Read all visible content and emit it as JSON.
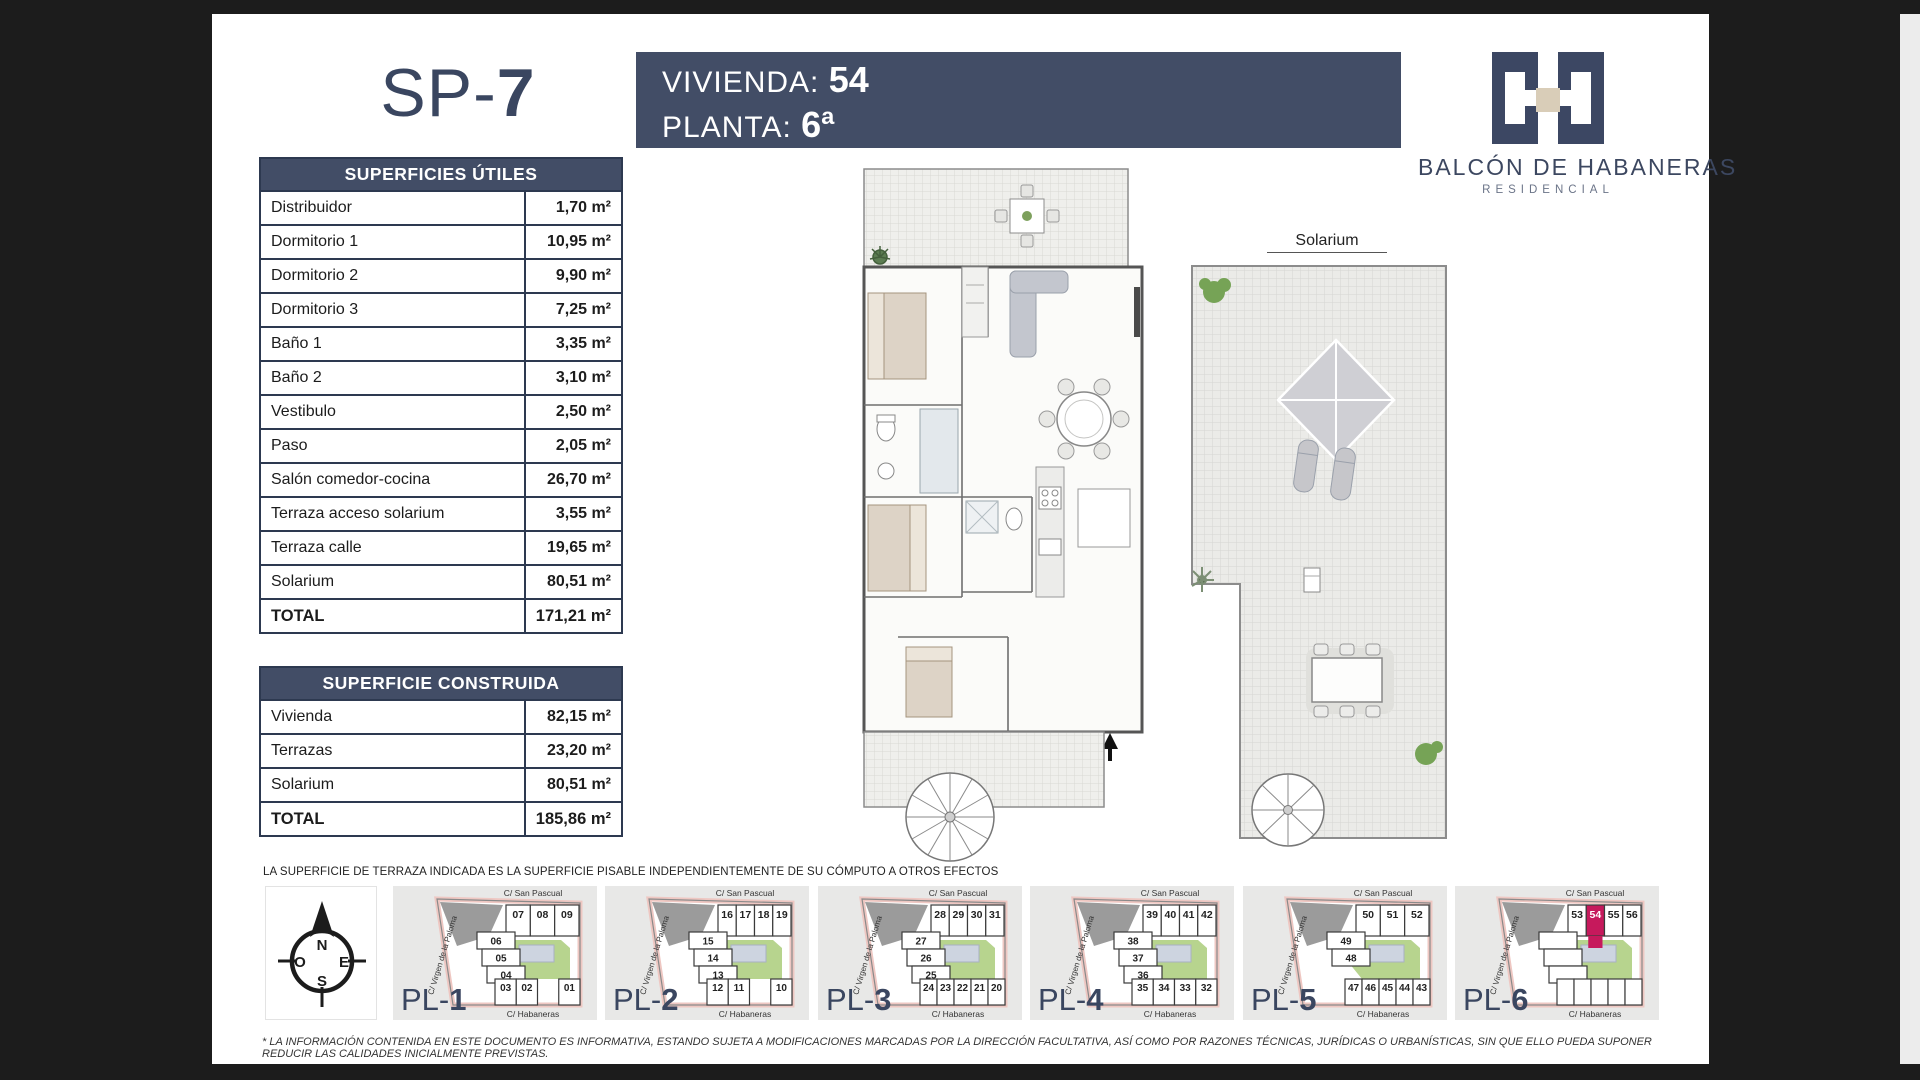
{
  "header": {
    "unit_code_prefix": "SP-",
    "unit_code_num": "7",
    "vivienda_label": "VIVIENDA:",
    "vivienda_value": "54",
    "planta_label": "PLANTA:",
    "planta_value": "6ª"
  },
  "brand": {
    "name": "BALCÓN DE HABANERAS",
    "subtitle": "RESIDENCIAL"
  },
  "solarium_label": "Solarium",
  "tables": {
    "useful": {
      "title": "SUPERFICIES ÚTILES",
      "rows": [
        {
          "label": "Distribuidor",
          "value": "1,70 m²"
        },
        {
          "label": "Dormitorio 1",
          "value": "10,95 m²"
        },
        {
          "label": "Dormitorio 2",
          "value": "9,90 m²"
        },
        {
          "label": "Dormitorio 3",
          "value": "7,25 m²"
        },
        {
          "label": "Baño 1",
          "value": "3,35 m²"
        },
        {
          "label": "Baño 2",
          "value": "3,10 m²"
        },
        {
          "label": "Vestibulo",
          "value": "2,50 m²"
        },
        {
          "label": "Paso",
          "value": "2,05 m²"
        },
        {
          "label": "Salón comedor-cocina",
          "value": "26,70 m²"
        },
        {
          "label": "Terraza acceso solarium",
          "value": "3,55 m²"
        },
        {
          "label": "Terraza calle",
          "value": "19,65 m²"
        },
        {
          "label": "Solarium",
          "value": "80,51 m²"
        },
        {
          "label": "TOTAL",
          "value": "171,21 m²"
        }
      ]
    },
    "built": {
      "title": "SUPERFICIE CONSTRUIDA",
      "rows": [
        {
          "label": "Vivienda",
          "value": "82,15 m²"
        },
        {
          "label": "Terrazas",
          "value": "23,20 m²"
        },
        {
          "label": "Solarium",
          "value": "80,51 m²"
        },
        {
          "label": "TOTAL",
          "value": "185,86 m²"
        }
      ]
    }
  },
  "terrace_note": "LA SUPERFICIE DE TERRAZA INDICADA ES LA SUPERFICIE PISABLE INDEPENDIENTEMENTE DE SU CÓMPUTO A OTROS EFECTOS",
  "disclaimer": "* LA INFORMACIÓN CONTENIDA EN ESTE DOCUMENTO ES INFORMATIVA, ESTANDO SUJETA A MODIFICACIONES MARCADAS POR LA DIRECCIÓN FACULTATIVA, ASÍ COMO POR RAZONES TÉCNICAS, JURÍDICAS O URBANÍSTICAS, SIN QUE ELLO PUEDA SUPONER REDUCIR LAS CALIDADES INICIALMENTE PREVISTAS.",
  "compass": {
    "n": "N",
    "s": "S",
    "e": "E",
    "o": "O"
  },
  "streets": {
    "top": "C/ San  Pascual",
    "left": "C/ Virgen de la Paloma",
    "bottom": "C/ Habaneras"
  },
  "plans": [
    {
      "label_prefix": "PL-",
      "label_num": "1",
      "top_units": [
        "07",
        "08",
        "09"
      ],
      "left_units": [
        "06",
        "05",
        "04"
      ],
      "bottom_units": [
        "03",
        "02",
        null,
        "01"
      ],
      "highlight": ""
    },
    {
      "label_prefix": "PL-",
      "label_num": "2",
      "top_units": [
        "16",
        "17",
        "18",
        "19"
      ],
      "left_units": [
        "15",
        "14",
        "13"
      ],
      "bottom_units": [
        "12",
        "11",
        null,
        "10"
      ],
      "highlight": ""
    },
    {
      "label_prefix": "PL-",
      "label_num": "3",
      "top_units": [
        "28",
        "29",
        "30",
        "31"
      ],
      "left_units": [
        "27",
        "26",
        "25"
      ],
      "bottom_units": [
        "24",
        "23",
        "22",
        "21",
        "20"
      ],
      "highlight": ""
    },
    {
      "label_prefix": "PL-",
      "label_num": "4",
      "top_units": [
        "39",
        "40",
        "41",
        "42"
      ],
      "left_units": [
        "38",
        "37",
        "36"
      ],
      "bottom_units": [
        "35",
        "34",
        "33",
        "32"
      ],
      "highlight": ""
    },
    {
      "label_prefix": "PL-",
      "label_num": "5",
      "top_units": [
        "50",
        "51",
        "52"
      ],
      "left_units": [
        "49",
        "48"
      ],
      "bottom_units": [
        "47",
        "46",
        "45",
        "44",
        "43"
      ],
      "highlight": ""
    },
    {
      "label_prefix": "PL-",
      "label_num": "6",
      "top_units": [
        "53",
        "54",
        "55",
        "56"
      ],
      "left_units": [
        "",
        "",
        ""
      ],
      "bottom_units": [
        "",
        "",
        "",
        "",
        ""
      ],
      "highlight": "54"
    }
  ],
  "colors": {
    "navy": "#424d66",
    "navy_dark": "#2d3950",
    "accent": "#c6195c",
    "green": "#b7d48e",
    "beige": "#d9cdb8",
    "card_gray": "#e8e8e7",
    "street_pink": "#eec7c2",
    "pool": "#cdd4e0"
  }
}
